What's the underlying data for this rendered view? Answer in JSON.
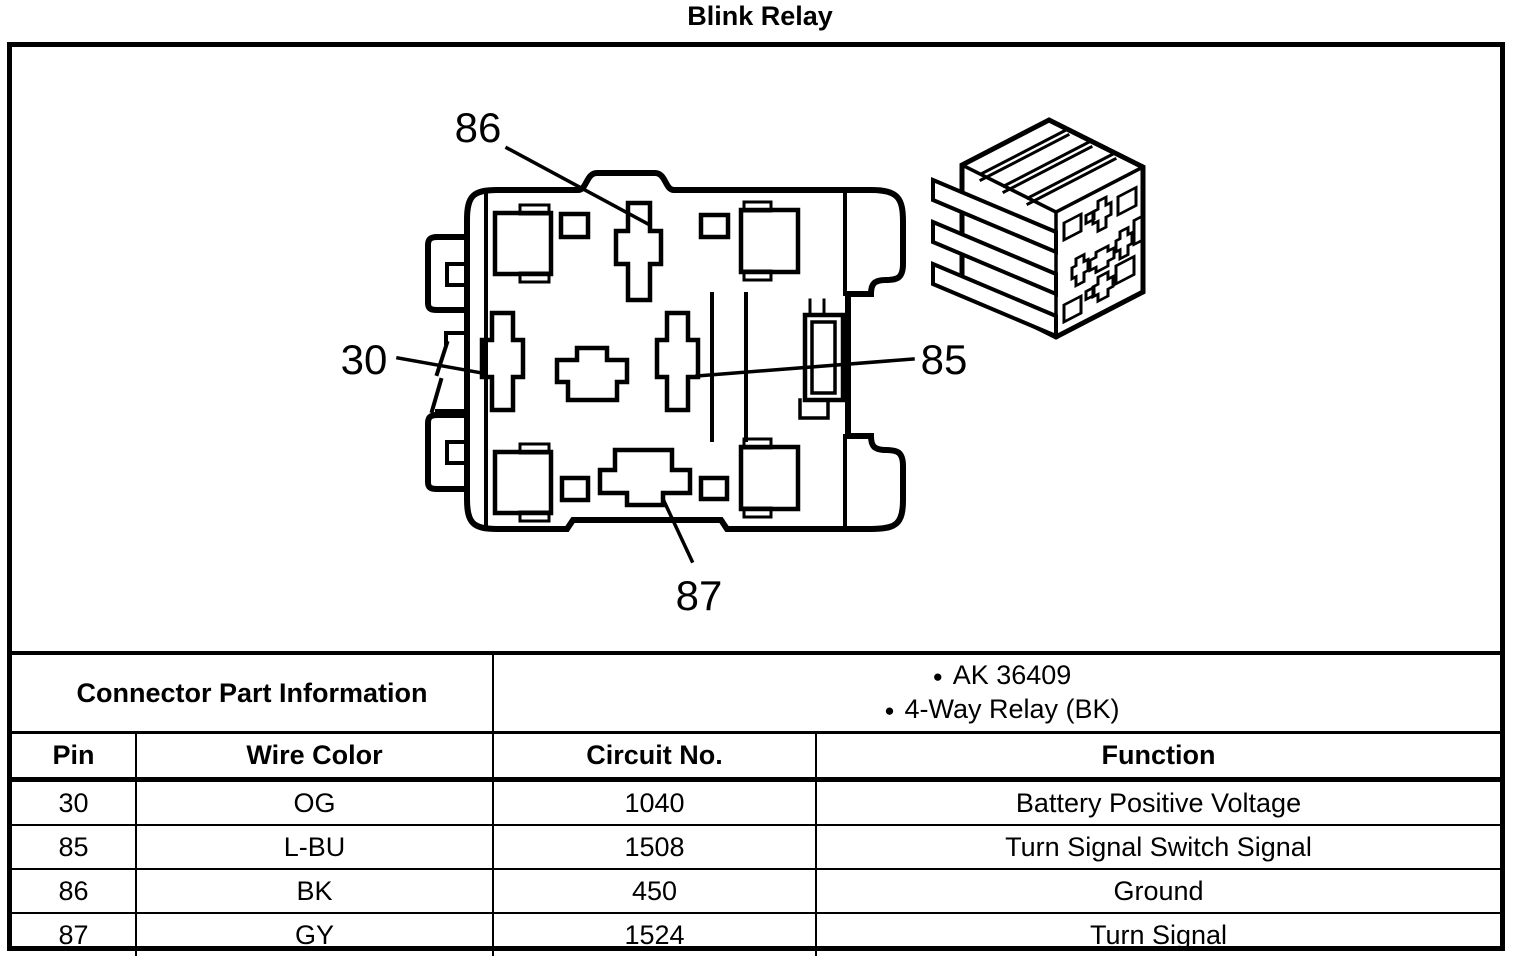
{
  "page": {
    "title": "Blink Relay",
    "background_color": "#ffffff",
    "line_color": "#000000"
  },
  "diagram": {
    "pin_labels": {
      "top": "86",
      "left": "30",
      "right": "85",
      "bottom": "87"
    },
    "views": {
      "face_view": "4-way relay connector face view with pin cavities",
      "isometric_view": "relay connector isometric view"
    }
  },
  "table": {
    "part_info": {
      "label": "Connector Part Information",
      "bullets": [
        "AK 36409",
        "4-Way Relay (BK)"
      ]
    },
    "headers": {
      "pin": "Pin",
      "wire_color": "Wire Color",
      "circuit_no": "Circuit No.",
      "function": "Function"
    },
    "rows": [
      {
        "pin": "30",
        "wire_color": "OG",
        "circuit_no": "1040",
        "function": "Battery Positive Voltage"
      },
      {
        "pin": "85",
        "wire_color": "L-BU",
        "circuit_no": "1508",
        "function": "Turn Signal Switch Signal"
      },
      {
        "pin": "86",
        "wire_color": "BK",
        "circuit_no": "450",
        "function": "Ground"
      },
      {
        "pin": "87",
        "wire_color": "GY",
        "circuit_no": "1524",
        "function": "Turn Signal"
      }
    ]
  }
}
